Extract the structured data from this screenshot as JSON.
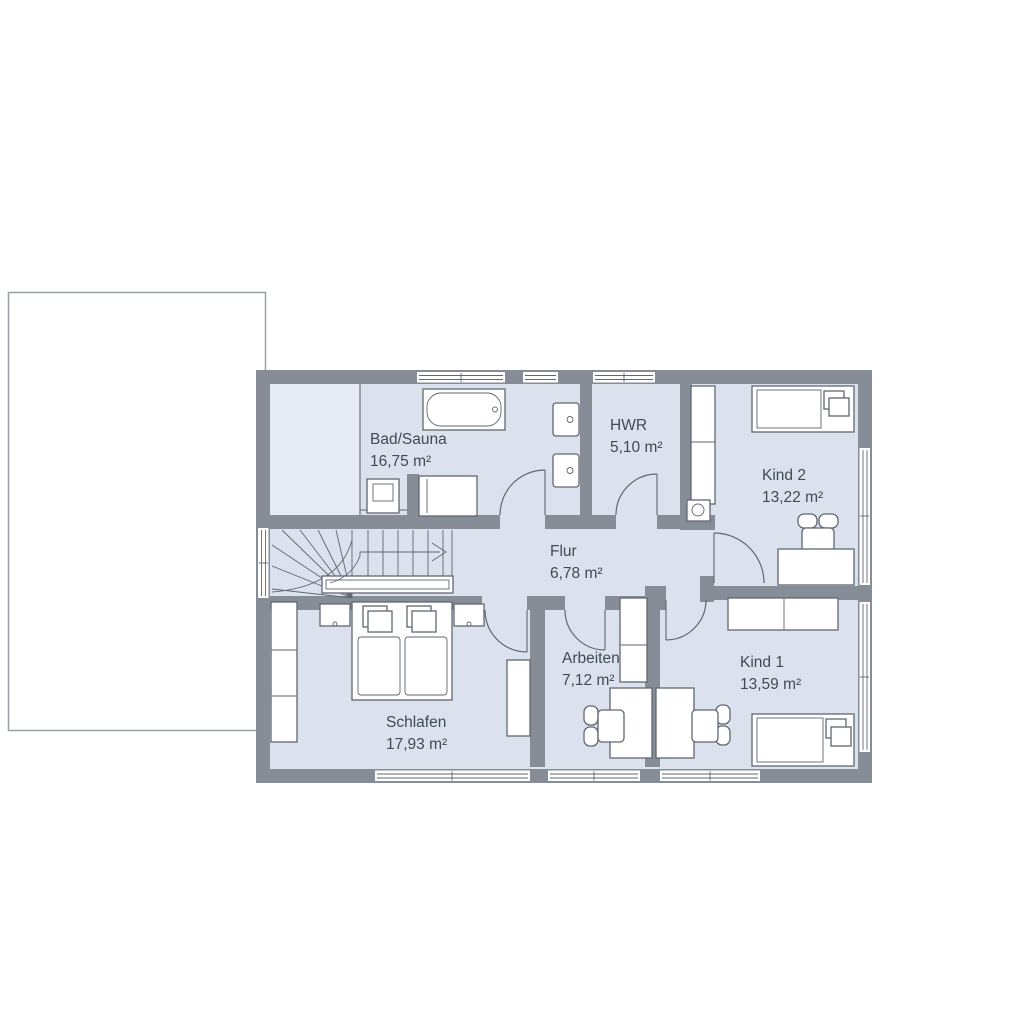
{
  "floorplan": {
    "rooms": [
      {
        "id": "bad-sauna",
        "name": "Bad/Sauna",
        "area": "16,75 m²"
      },
      {
        "id": "hwr",
        "name": "HWR",
        "area": "5,10 m²"
      },
      {
        "id": "kind-2",
        "name": "Kind 2",
        "area": "13,22 m²"
      },
      {
        "id": "flur",
        "name": "Flur",
        "area": "6,78 m²"
      },
      {
        "id": "schlafen",
        "name": "Schlafen",
        "area": "17,93 m²"
      },
      {
        "id": "arbeiten",
        "name": "Arbeiten",
        "area": "7,12 m²"
      },
      {
        "id": "kind-1",
        "name": "Kind 1",
        "area": "13,59 m²"
      }
    ],
    "colors": {
      "wall": "#868d96",
      "floor": "#dbe2ee",
      "sauna": "#e6eaf3",
      "line": "#5f6771",
      "text": "#3f4a57",
      "outline": "#9aa0a8",
      "bg": "#ffffff"
    }
  }
}
